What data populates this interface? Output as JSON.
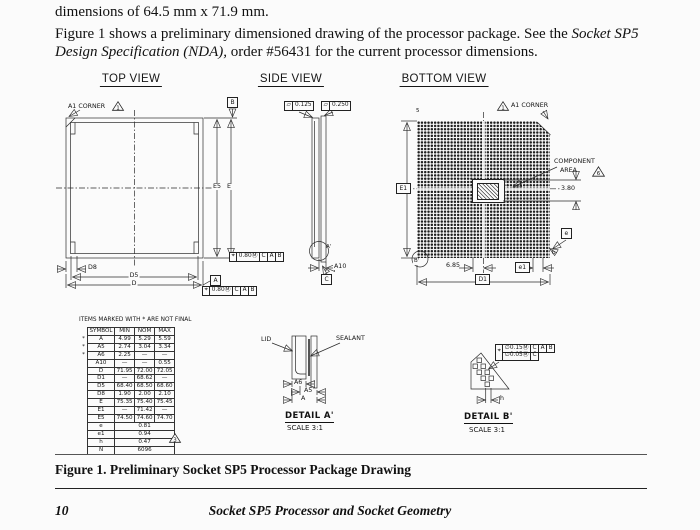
{
  "intro": {
    "line1": "dimensions of 64.5 mm x 71.9 mm.",
    "para_before": "Figure 1 shows a preliminary dimensioned drawing of the processor package. See the ",
    "para_italic": "Socket SP5 Design Specification (NDA),",
    "para_after": " order #56431 for the current processor dimensions."
  },
  "views": {
    "top": {
      "title": "TOP VIEW",
      "a1_corner": "A1 CORNER",
      "a1_note": "1",
      "datum_b": "B",
      "datum_a": "A",
      "dim_e5": "E5",
      "dim_e": "E",
      "dim_d8": "D8",
      "dim_d5": "D5",
      "dim_d": "D",
      "fcf1": {
        "sym": "⌖",
        "tol": "0.80",
        "mod": "Ⓜ",
        "d1": "C",
        "d2": "A",
        "d3": "B"
      },
      "fcf2": {
        "sym": "⌖",
        "tol": "0.80",
        "mod": "Ⓜ",
        "d1": "C",
        "d2": "A",
        "d3": "B"
      }
    },
    "side": {
      "title": "SIDE VIEW",
      "flat_sym": "▱",
      "flatness1": "0.125",
      "flatness2": "0.250",
      "detail_ref": "A'",
      "dim_a10": "A10",
      "datum_c": "C"
    },
    "bottom": {
      "title": "BOTTOM VIEW",
      "a1_corner": "A1 CORNER",
      "a1_note": "1",
      "corner_tag": "5",
      "dim_e1": "E1",
      "component_area_line1": "COMPONENT",
      "component_area_line2": "AREA",
      "component_note": "6",
      "dim_380": "3.80",
      "dim_e": "e",
      "dim_b": "b",
      "dim_685": "6.85",
      "dim_e1_pitch": "e1",
      "dim_d1": "D1",
      "detail_ref": "B'"
    }
  },
  "table": {
    "note": "ITEMS MARKED WITH * ARE NOT FINAL",
    "headers": [
      "SYMBOL",
      "MIN",
      "NOM",
      "MAX"
    ],
    "rows": [
      {
        "star": "*",
        "sym": "A",
        "min": "4.99",
        "nom": "5.29",
        "max": "5.59"
      },
      {
        "star": "*",
        "sym": "A5",
        "min": "2.74",
        "nom": "3.04",
        "max": "3.34"
      },
      {
        "star": "*",
        "sym": "A6",
        "min": "2.25",
        "nom": "—",
        "max": "—"
      },
      {
        "star": "",
        "sym": "A10",
        "min": "—",
        "nom": "—",
        "max": "0.55"
      },
      {
        "star": "",
        "sym": "D",
        "min": "71.95",
        "nom": "72.00",
        "max": "72.05"
      },
      {
        "star": "",
        "sym": "D1",
        "min": "—",
        "nom": "68.62",
        "max": "—"
      },
      {
        "star": "",
        "sym": "D5",
        "min": "68.40",
        "nom": "68.50",
        "max": "68.60"
      },
      {
        "star": "",
        "sym": "D8",
        "min": "1.90",
        "nom": "2.00",
        "max": "2.10"
      },
      {
        "star": "",
        "sym": "E",
        "min": "75.35",
        "nom": "75.40",
        "max": "75.45"
      },
      {
        "star": "",
        "sym": "E1",
        "min": "—",
        "nom": "71.42",
        "max": "—"
      },
      {
        "star": "",
        "sym": "E5",
        "min": "74.50",
        "nom": "74.60",
        "max": "74.70"
      },
      {
        "star": "",
        "sym": "e",
        "span": "0.81"
      },
      {
        "star": "",
        "sym": "e1",
        "span": "0.94"
      },
      {
        "star": "",
        "sym": "h",
        "span": "0.47"
      },
      {
        "star": "",
        "sym": "N",
        "span": "6096"
      }
    ],
    "n_note": "3"
  },
  "detail_a": {
    "lid": "LID",
    "sealant": "SEALANT",
    "dim_a6": "A6",
    "dim_a5": "A5",
    "dim_a": "A",
    "title": "DETAIL A'",
    "scale": "SCALE  3:1"
  },
  "detail_b": {
    "fcf_row1": {
      "sym": "⌖",
      "tol": "∅0.15",
      "mod": "Ⓜ",
      "d1": "C",
      "d2": "A",
      "d3": "B"
    },
    "fcf_row2": {
      "tol": "∅0.05",
      "mod": "Ⓜ",
      "d1": "C"
    },
    "dim_h": "h",
    "title": "DETAIL B'",
    "scale": "SCALE  3:1"
  },
  "caption": "Figure 1.  Preliminary Socket SP5 Processor Package Drawing",
  "footer": {
    "page_number": "10",
    "title": "Socket SP5 Processor and Socket Geometry"
  }
}
